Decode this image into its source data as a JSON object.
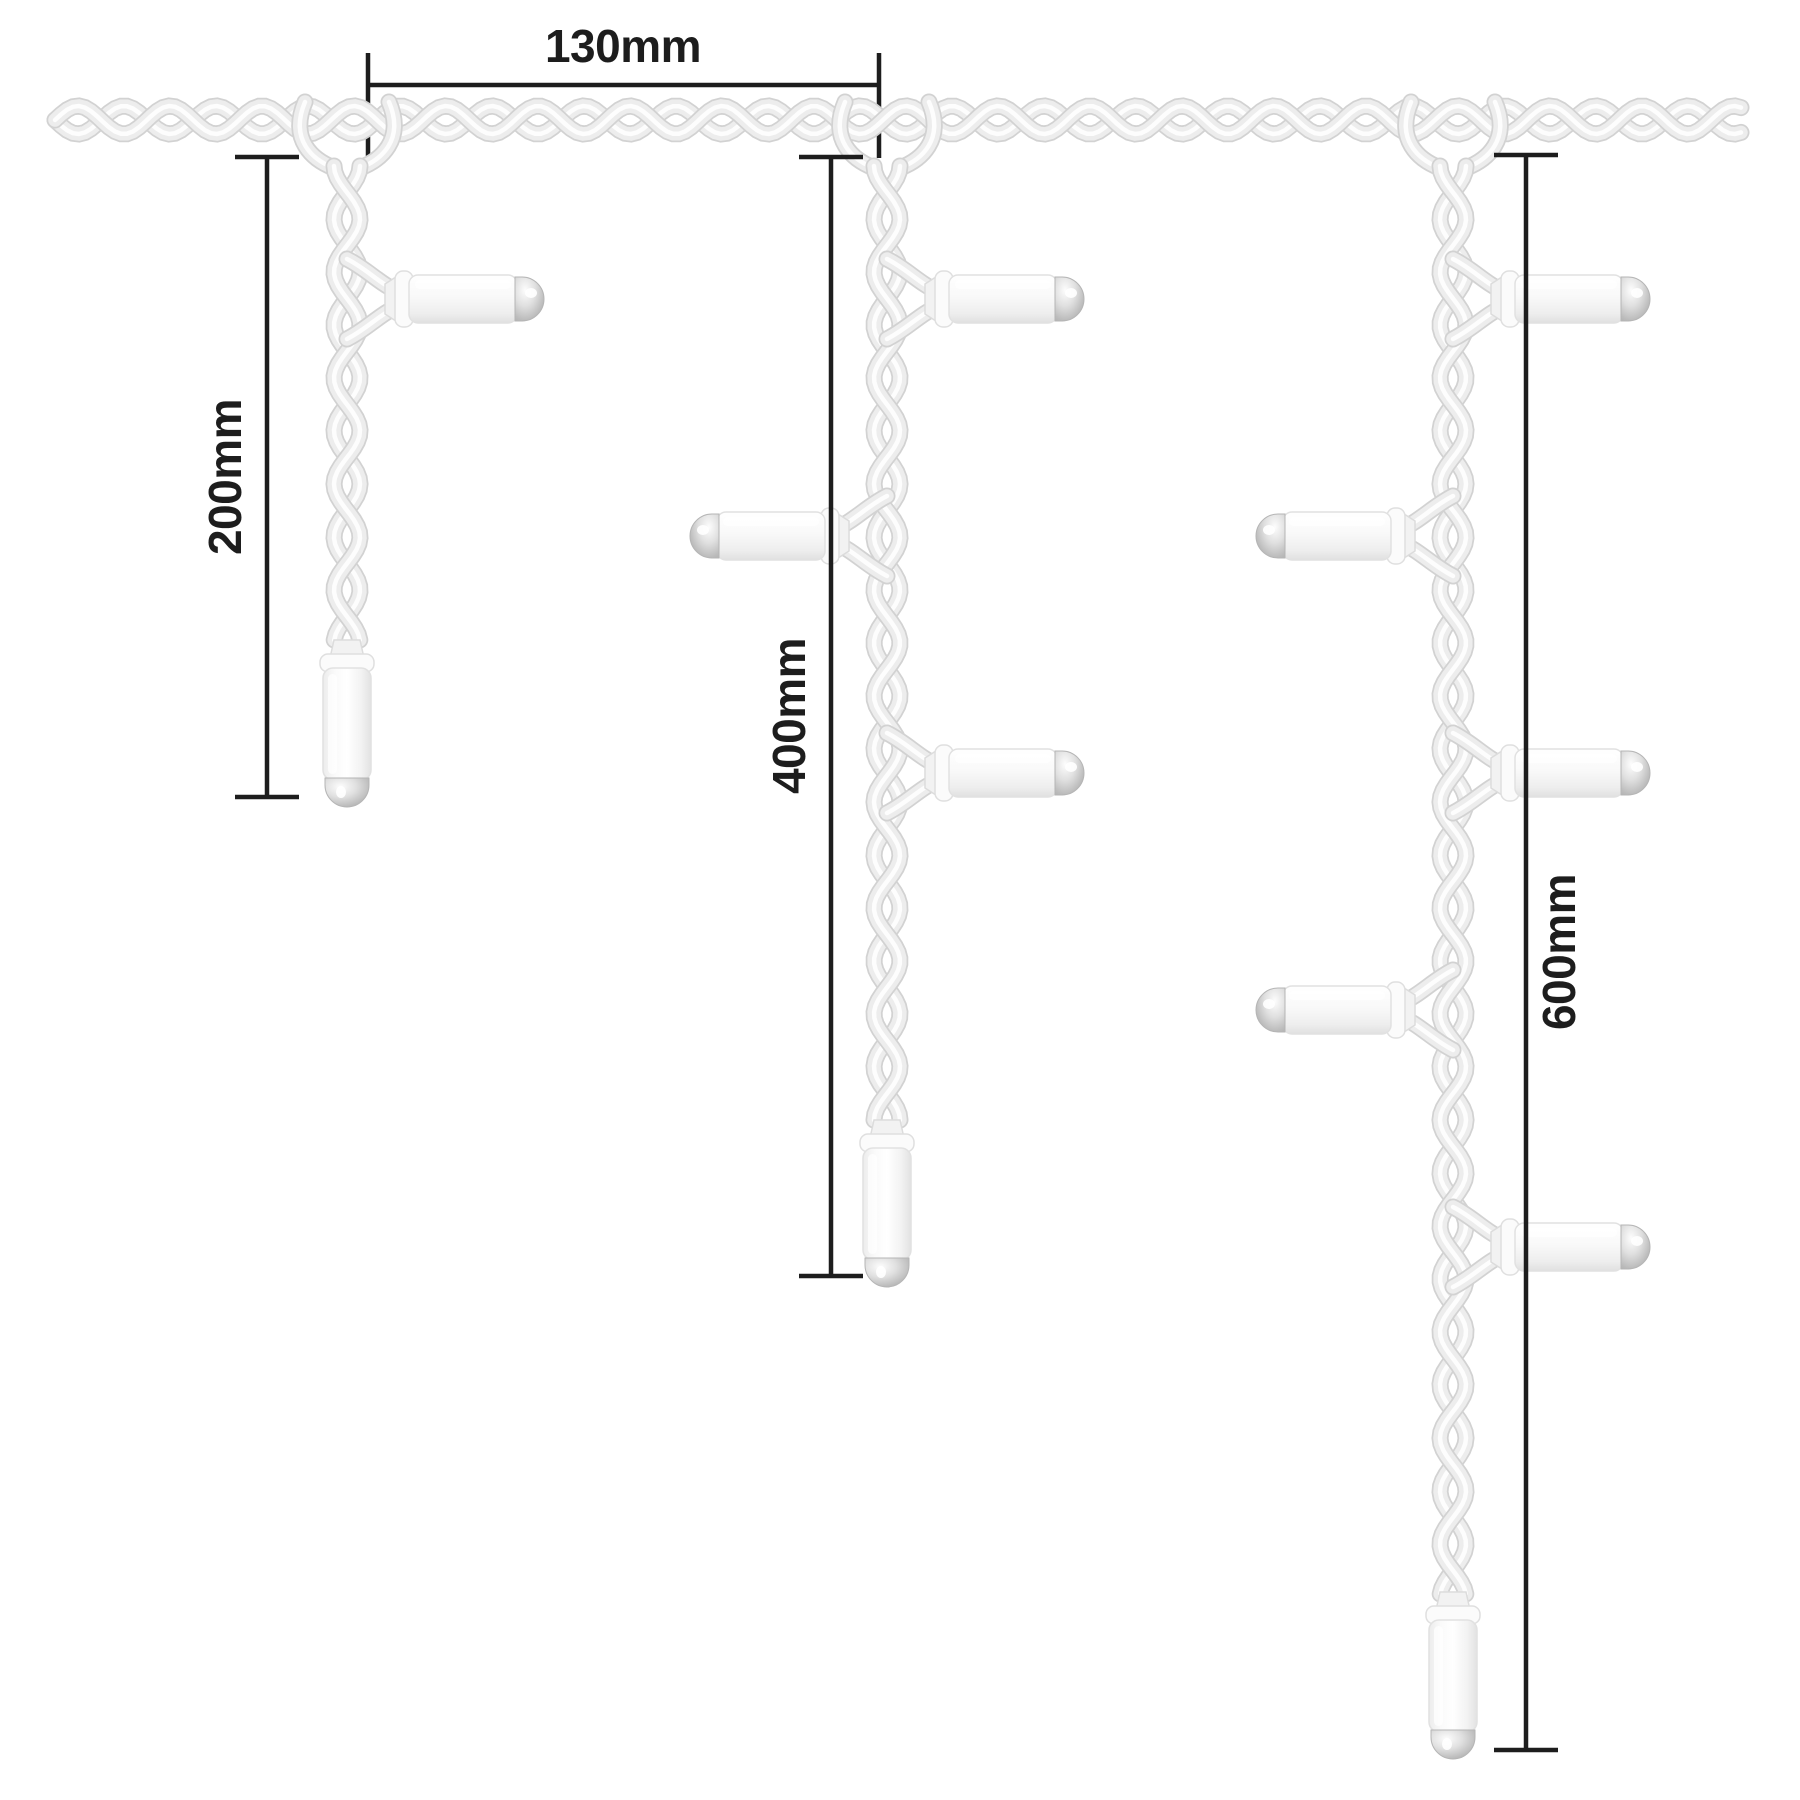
{
  "diagram": {
    "kind": "product-dimension-diagram",
    "subject": "icicle-lights-drop-lengths-and-spacing",
    "background": "#ffffff"
  },
  "colors": {
    "rope_fill": "#ededed",
    "rope_edge": "#d2d2d2",
    "rope_highlight": "#ffffff",
    "bulb_body_light": "#ffffff",
    "bulb_body_shade": "#e0e0e0",
    "bulb_body_edge": "#e1e1e1",
    "bulb_collar": "#fbfbfb",
    "bulb_cap_silver_dark": "#a8a8a8",
    "bulb_cap_silver_light": "#fdfdfd",
    "dimension_line": "#1d1d1d",
    "label_text": "#1d1d1d"
  },
  "dimensions": {
    "d130": {
      "label": "130mm",
      "value_mm": 130
    },
    "d200": {
      "label": "200mm",
      "value_mm": 200
    },
    "d400": {
      "label": "400mm",
      "value_mm": 400
    },
    "d600": {
      "label": "600mm",
      "value_mm": 600
    }
  },
  "figure": {
    "canvas": {
      "width": 1800,
      "height": 1800
    },
    "header_rope": {
      "y": 120,
      "x_start": 55,
      "x_end": 1745,
      "wavelength": 92,
      "amplitude": 14
    },
    "drop_rope": {
      "wavelength": 106,
      "amplitude": 13,
      "top_y": 166
    },
    "drops": [
      {
        "name": "drop-200mm",
        "x": 347,
        "rope_bottom": 642,
        "side_bulbs": [
          {
            "y": 299,
            "dir": "right"
          }
        ]
      },
      {
        "name": "drop-400mm",
        "x": 887,
        "rope_bottom": 1122,
        "side_bulbs": [
          {
            "y": 299,
            "dir": "right"
          },
          {
            "y": 536,
            "dir": "left"
          },
          {
            "y": 773,
            "dir": "right"
          }
        ]
      },
      {
        "name": "drop-600mm",
        "x": 1453,
        "rope_bottom": 1594,
        "side_bulbs": [
          {
            "y": 299,
            "dir": "right"
          },
          {
            "y": 536,
            "dir": "left"
          },
          {
            "y": 773,
            "dir": "right"
          },
          {
            "y": 1010,
            "dir": "left"
          },
          {
            "y": 1247,
            "dir": "right"
          }
        ]
      }
    ],
    "dimension_lines": {
      "d130": {
        "orientation": "horizontal",
        "line_y": 85,
        "x1": 368,
        "x2": 879,
        "tick_y1": 53,
        "tick_y2": 158,
        "label_x": 623,
        "label_y": 62
      },
      "d200": {
        "orientation": "vertical",
        "line_x": 267,
        "y1": 157,
        "y2": 797,
        "tick_x1": 235,
        "tick_x2": 299,
        "label_x": 226,
        "label_y": 477
      },
      "d400": {
        "orientation": "vertical",
        "line_x": 831,
        "y1": 157,
        "y2": 1276,
        "tick_x1": 799,
        "tick_x2": 863,
        "label_x": 790,
        "label_y": 716
      },
      "d600": {
        "orientation": "vertical",
        "line_x": 1526,
        "y1": 155,
        "y2": 1750,
        "tick_x1": 1494,
        "tick_x2": 1558,
        "label_x": 1560,
        "label_y": 952
      }
    }
  }
}
